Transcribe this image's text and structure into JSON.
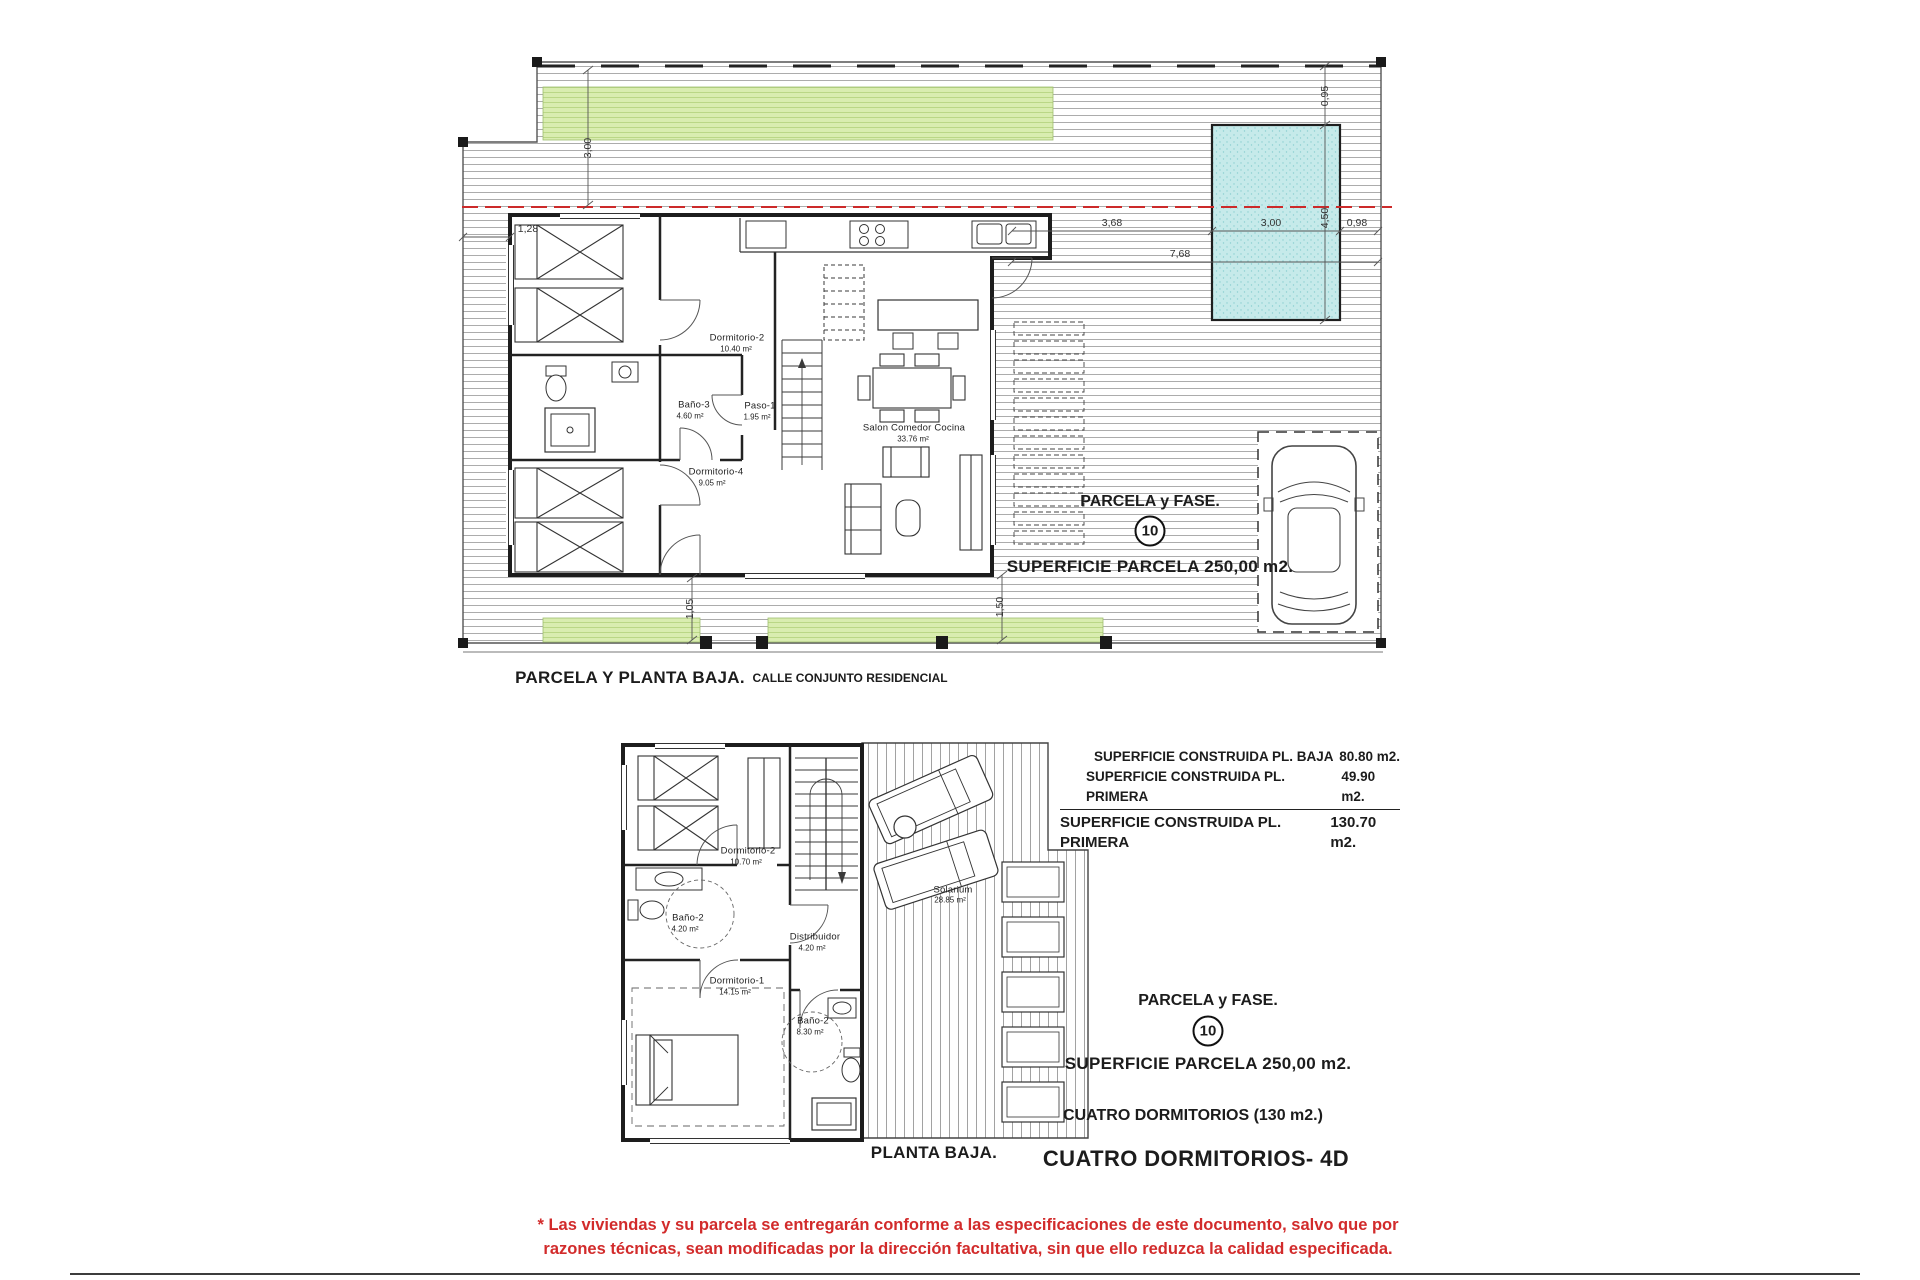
{
  "top_plan": {
    "caption": "PARCELA Y PLANTA BAJA.",
    "street": "CALLE CONJUNTO RESIDENCIAL",
    "parcel_title": "PARCELA y FASE.",
    "parcel_number": "10",
    "parcel_area": "SUPERFICIE PARCELA 250,00 m2.",
    "rooms": [
      {
        "name": "Dormitorio-2",
        "area": "10.40 m²"
      },
      {
        "name": "Baño-3",
        "area": "4.60 m²"
      },
      {
        "name": "Paso-1",
        "area": "1.95 m²"
      },
      {
        "name": "Dormitorio-4",
        "area": "9.05 m²"
      },
      {
        "name": "Salon Comedor Cocina",
        "area": "33.76 m²"
      }
    ],
    "dims": {
      "garden_depth": "3,00",
      "side_setback": "1,28",
      "pool_offset": "0,95",
      "pool_length": "4,50",
      "house_to_pool": "3,68",
      "pool_width": "3,00",
      "pool_to_fence": "0,98",
      "house_to_fence": "7,68",
      "front_left": "1,05",
      "front_right": "1,50"
    }
  },
  "bottom_plan": {
    "caption": "PLANTA BAJA.",
    "rooms": [
      {
        "name": "Dormitorio-2",
        "area": "10.70 m²"
      },
      {
        "name": "Baño-2",
        "area": "4.20 m²"
      },
      {
        "name": "Distribuidor",
        "area": "4.20 m²"
      },
      {
        "name": "Dormitorio-1",
        "area": "14.15 m²"
      },
      {
        "name": "Baño-2",
        "area": "8.30 m²"
      },
      {
        "name": "Solarium",
        "area": "28.85 m²"
      }
    ],
    "areas": [
      {
        "label": "SUPERFICIE CONSTRUIDA PL. BAJA",
        "value": "80.80 m2."
      },
      {
        "label": "SUPERFICIE CONSTRUIDA PL. PRIMERA",
        "value": "49.90 m2."
      },
      {
        "label": "SUPERFICIE CONSTRUIDA PL. PRIMERA",
        "value": "130.70  m2."
      }
    ],
    "parcel_title": "PARCELA y FASE.",
    "parcel_number": "10",
    "parcel_area": "SUPERFICIE PARCELA 250,00 m2.",
    "type_note": "CUATRO DORMITORIOS (130 m2.)",
    "type_title": "CUATRO DORMITORIOS- 4D"
  },
  "disclaimer": {
    "line1": "* Las viviendas y su parcela se entregarán conforme a las especificaciones de este documento, salvo que por",
    "line2": "razones técnicas, sean modificadas por la dirección facultativa, sin que ello reduzca la calidad especificada.",
    "color": "#d22b2b"
  },
  "colors": {
    "building_line_red": "#cc2a2a",
    "garden_green": "#d9edb0",
    "pool_cyan": "#c6eaea"
  }
}
